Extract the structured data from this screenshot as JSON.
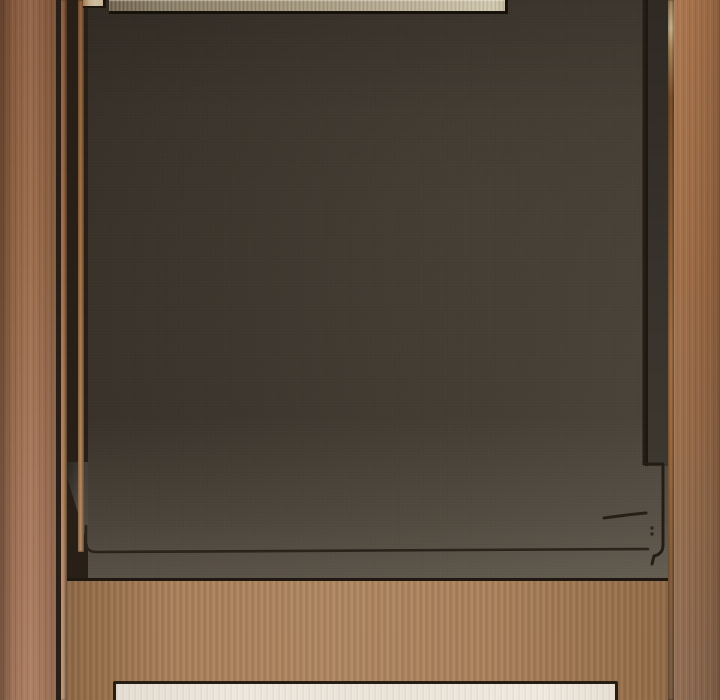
{
  "scene": {
    "description": "Close-up photograph of a dark appliance door panel framed by copper-bronze cabinetry: a brushed-steel strip is visible at the very top, thin copper pinstripes run down both sides, a wood-grain toe-kick band sits below the door, and a white plinth panel with a dark border emerges at the bottom edge. Thin dark seam lines outline the door edge and a latch detail at the lower right.",
    "parts": [
      {
        "name": "cabinet-left-stile",
        "color": "#9a6a4a"
      },
      {
        "name": "copper-pinstripe-left-outer",
        "color": "#b98a64"
      },
      {
        "name": "copper-pinstripe-left-inner",
        "color": "#cf9a66"
      },
      {
        "name": "appliance-door-panel",
        "color": "#3d362d"
      },
      {
        "name": "door-edge-left-highlight",
        "color": "#58524a"
      },
      {
        "name": "door-right-edge-shade",
        "color": "#353029"
      },
      {
        "name": "steel-strip-tab",
        "color": "#cdbfa4"
      },
      {
        "name": "steel-control-strip",
        "color": "#c3b89e"
      },
      {
        "name": "copper-pinstripe-right",
        "color": "#bb8352"
      },
      {
        "name": "cabinet-right-stile",
        "color": "#9d6b45"
      },
      {
        "name": "toe-kick-wood-band",
        "color": "#a87d57"
      },
      {
        "name": "white-plinth-panel",
        "color": "#efe9df"
      },
      {
        "name": "seam-lines",
        "color": "#241e16"
      }
    ]
  }
}
